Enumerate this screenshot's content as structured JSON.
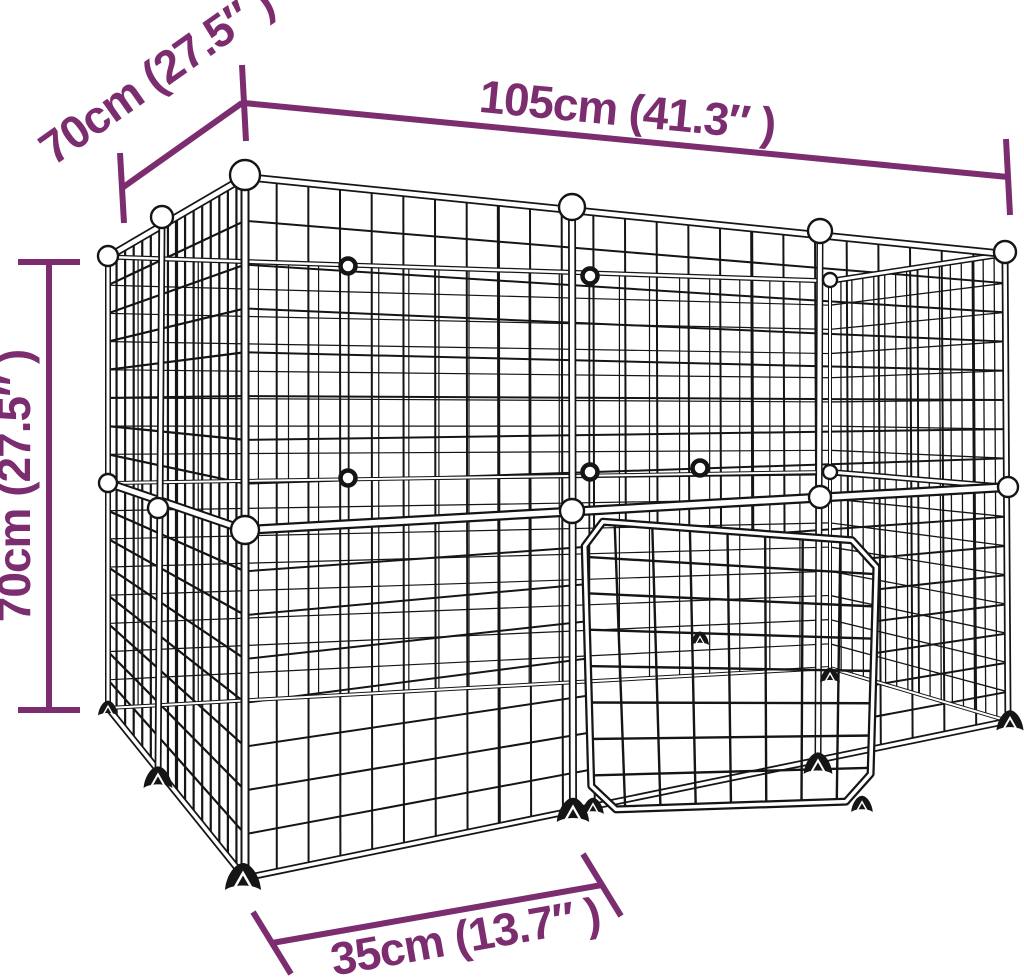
{
  "meta": {
    "description": "Dimension diagram of a black wire mesh pet playpen with door",
    "background": "#ffffff"
  },
  "colors": {
    "dimension": "#7B2D6F",
    "wire": "#151515",
    "tube": "#ffffff",
    "connector": "#ffffff"
  },
  "dimensions": {
    "width": {
      "label": "105cm (41.3″ )"
    },
    "depth": {
      "label": "70cm (27.5″ )"
    },
    "height": {
      "label": "70cm (27.5″ )"
    },
    "door": {
      "label": "35cm (13.7″ )"
    }
  }
}
